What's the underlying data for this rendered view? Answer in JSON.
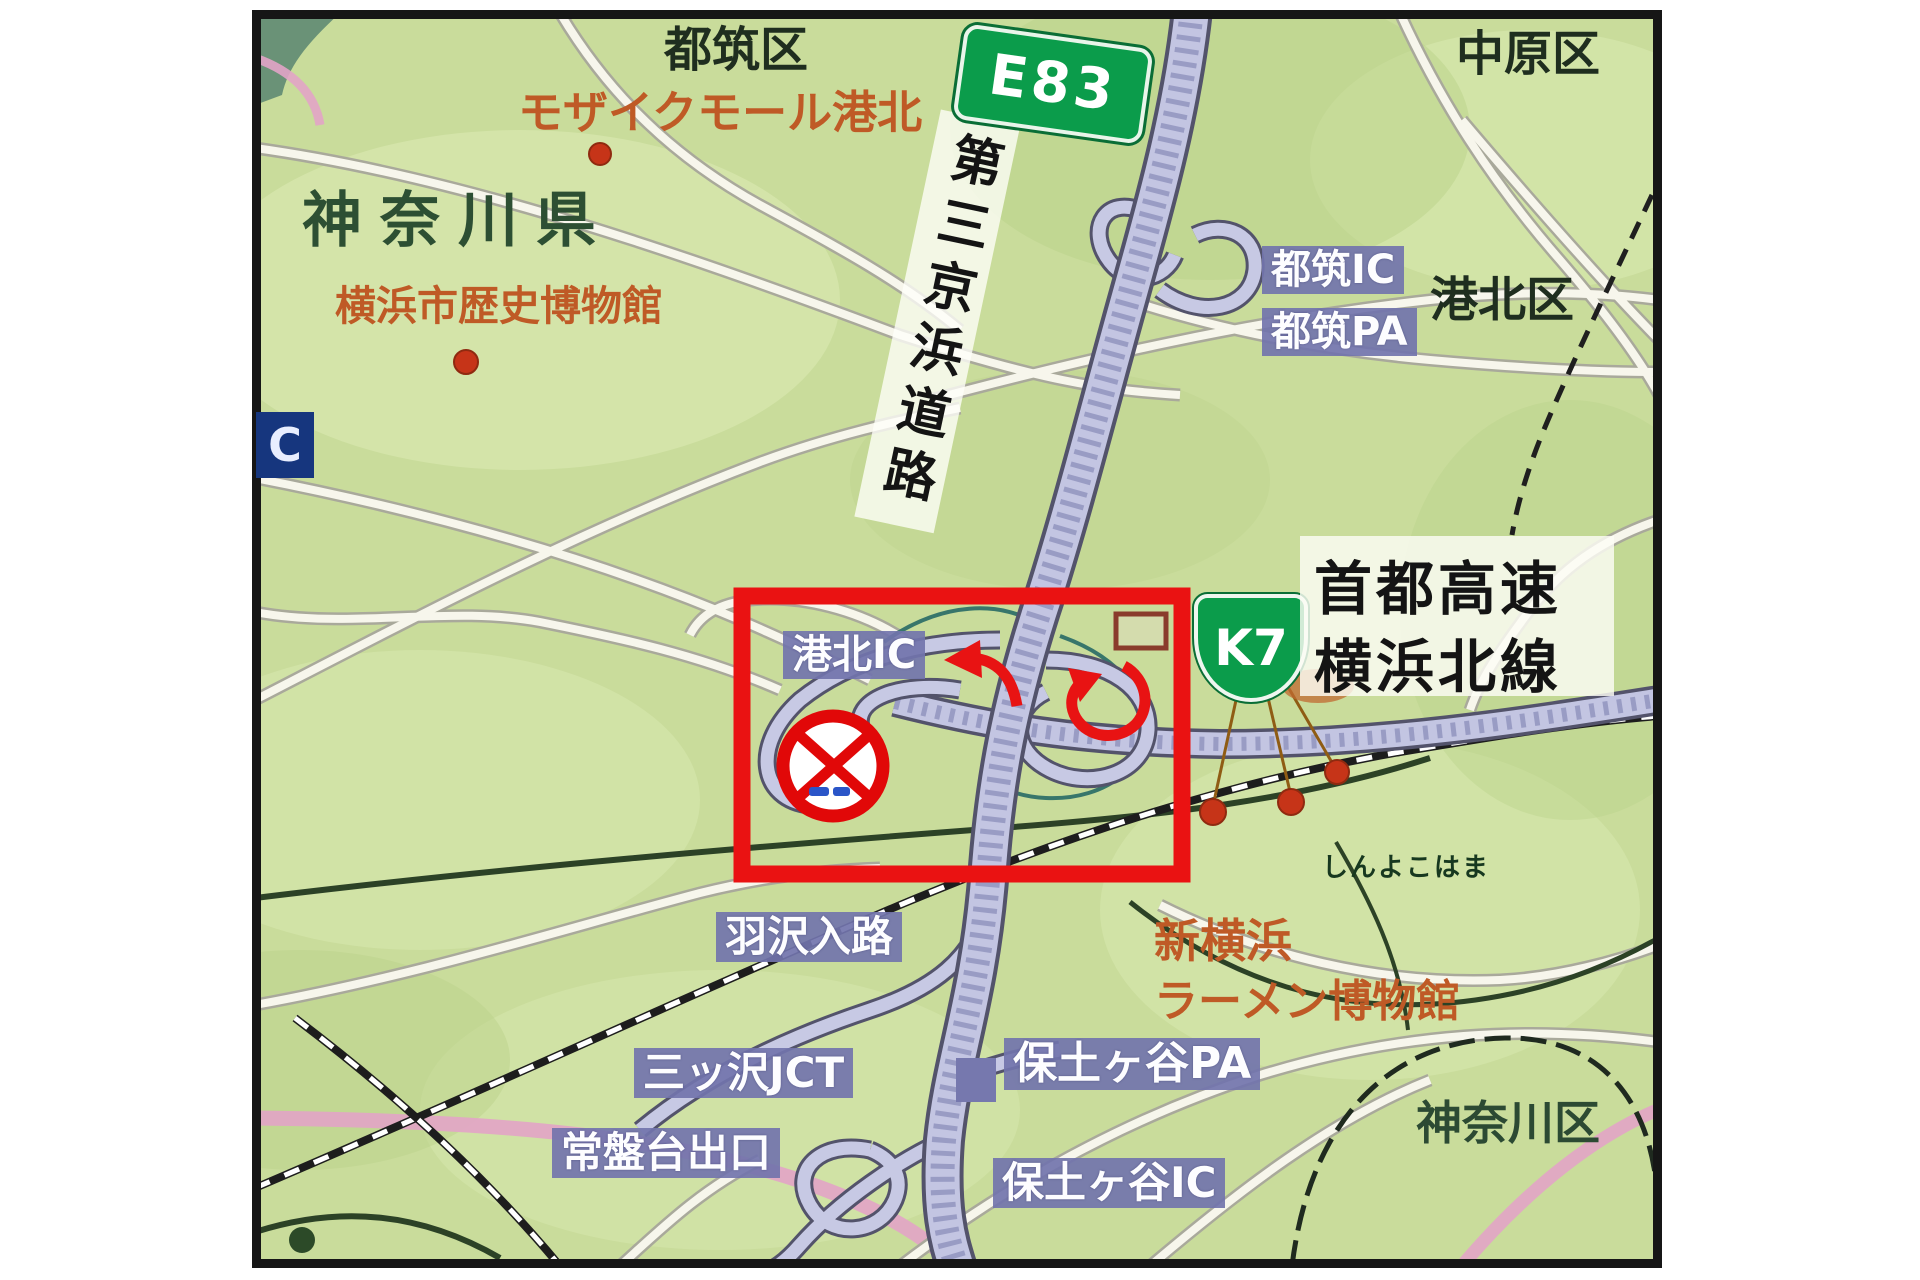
{
  "colors": {
    "map_bg": "#c9dc9b",
    "highway_fill": "#c3c5e2",
    "road_fill": "#f7f6ec",
    "label_bg": "#7276ac",
    "shield_green": "#0b9c4b",
    "highlight_red": "#ea1212",
    "orange_text": "#bf5a26",
    "dark_green_text": "#2d4f33",
    "pink_road": "#e2a4c6"
  },
  "shields": {
    "e83": "E83",
    "k7": "K7"
  },
  "roads": {
    "daisan_keihin_vertical": "第三京浜道路",
    "shuto_line1": "首都高速",
    "shuto_line2": "横浜北線"
  },
  "areas": {
    "prefecture": "神奈川県",
    "tsuzuki_ward": "都筑区",
    "nakahara_ward": "中原区",
    "kohoku_ward": "港北区",
    "kanagawa_ward": "神奈川区"
  },
  "interchanges": {
    "tsuzuki_ic": "都筑IC",
    "tsuzuki_pa": "都筑PA",
    "kohoku_ic": "港北IC",
    "hazawa_entry": "羽沢入路",
    "mitsuzawa_jct": "三ッ沢JCT",
    "tokiwadai_exit": "常盤台出口",
    "hodogaya_pa": "保土ヶ谷PA",
    "hodogaya_ic": "保土ヶ谷IC"
  },
  "pois": {
    "mosaic_mall": "モザイクモール港北",
    "history_museum": "横浜市歴史博物館",
    "shin_yokohama": "新横浜",
    "ramen_museum": "ラーメン博物館",
    "shin_yokohama_station": "しんよこはま"
  },
  "edge_label_partial": "C"
}
